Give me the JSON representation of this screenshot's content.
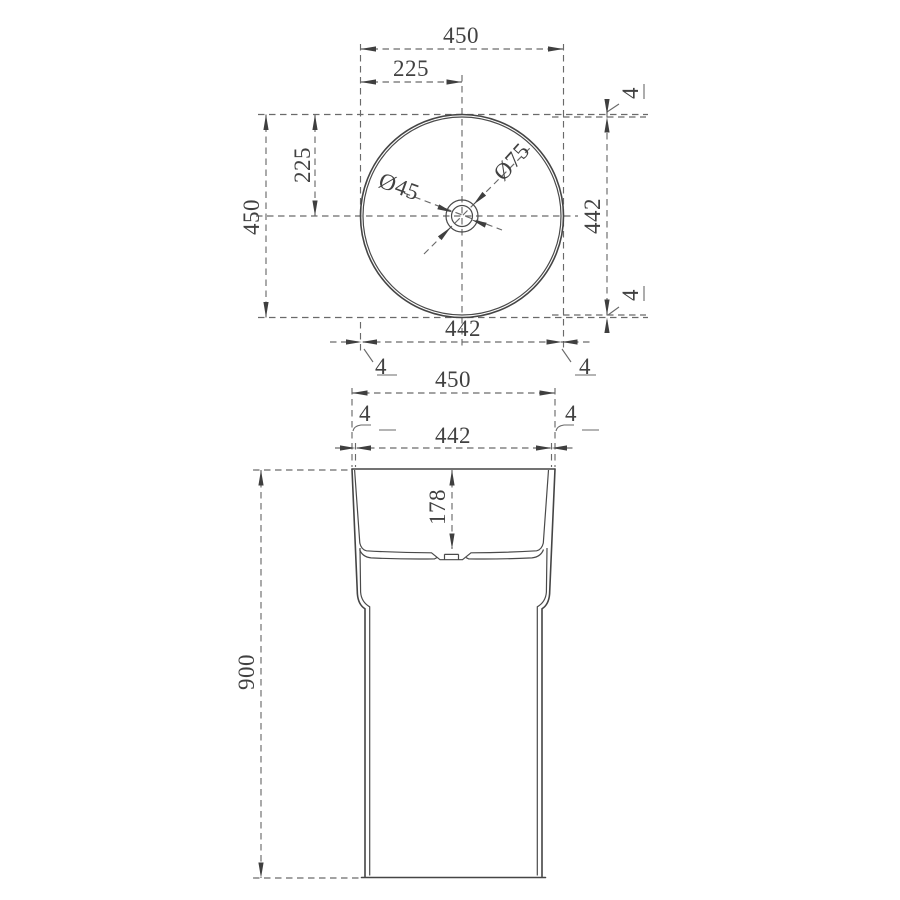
{
  "drawing": {
    "type": "technical-dimension-drawing",
    "subject": "pedestal-basin",
    "colors": {
      "background": "#ffffff",
      "object_line": "#454545",
      "dimension_line": "#6a6a6a",
      "text": "#414141"
    },
    "top_view": {
      "dim_width_outer": "450",
      "dim_width_half": "225",
      "dim_height_half": "225",
      "dim_height_outer": "450",
      "dim_height_inner": "442",
      "dim_wall_top": "4",
      "dim_wall_bottom": "4",
      "dim_width_inner": "442",
      "dim_wall_left": "4",
      "dim_wall_right": "4",
      "dim_drain_small": "Ø45",
      "dim_drain_large": "Ø75"
    },
    "front_view": {
      "dim_width_outer": "450",
      "dim_wall_left": "4",
      "dim_wall_right": "4",
      "dim_width_inner": "442",
      "dim_basin_depth": "178",
      "dim_total_height": "900"
    }
  }
}
